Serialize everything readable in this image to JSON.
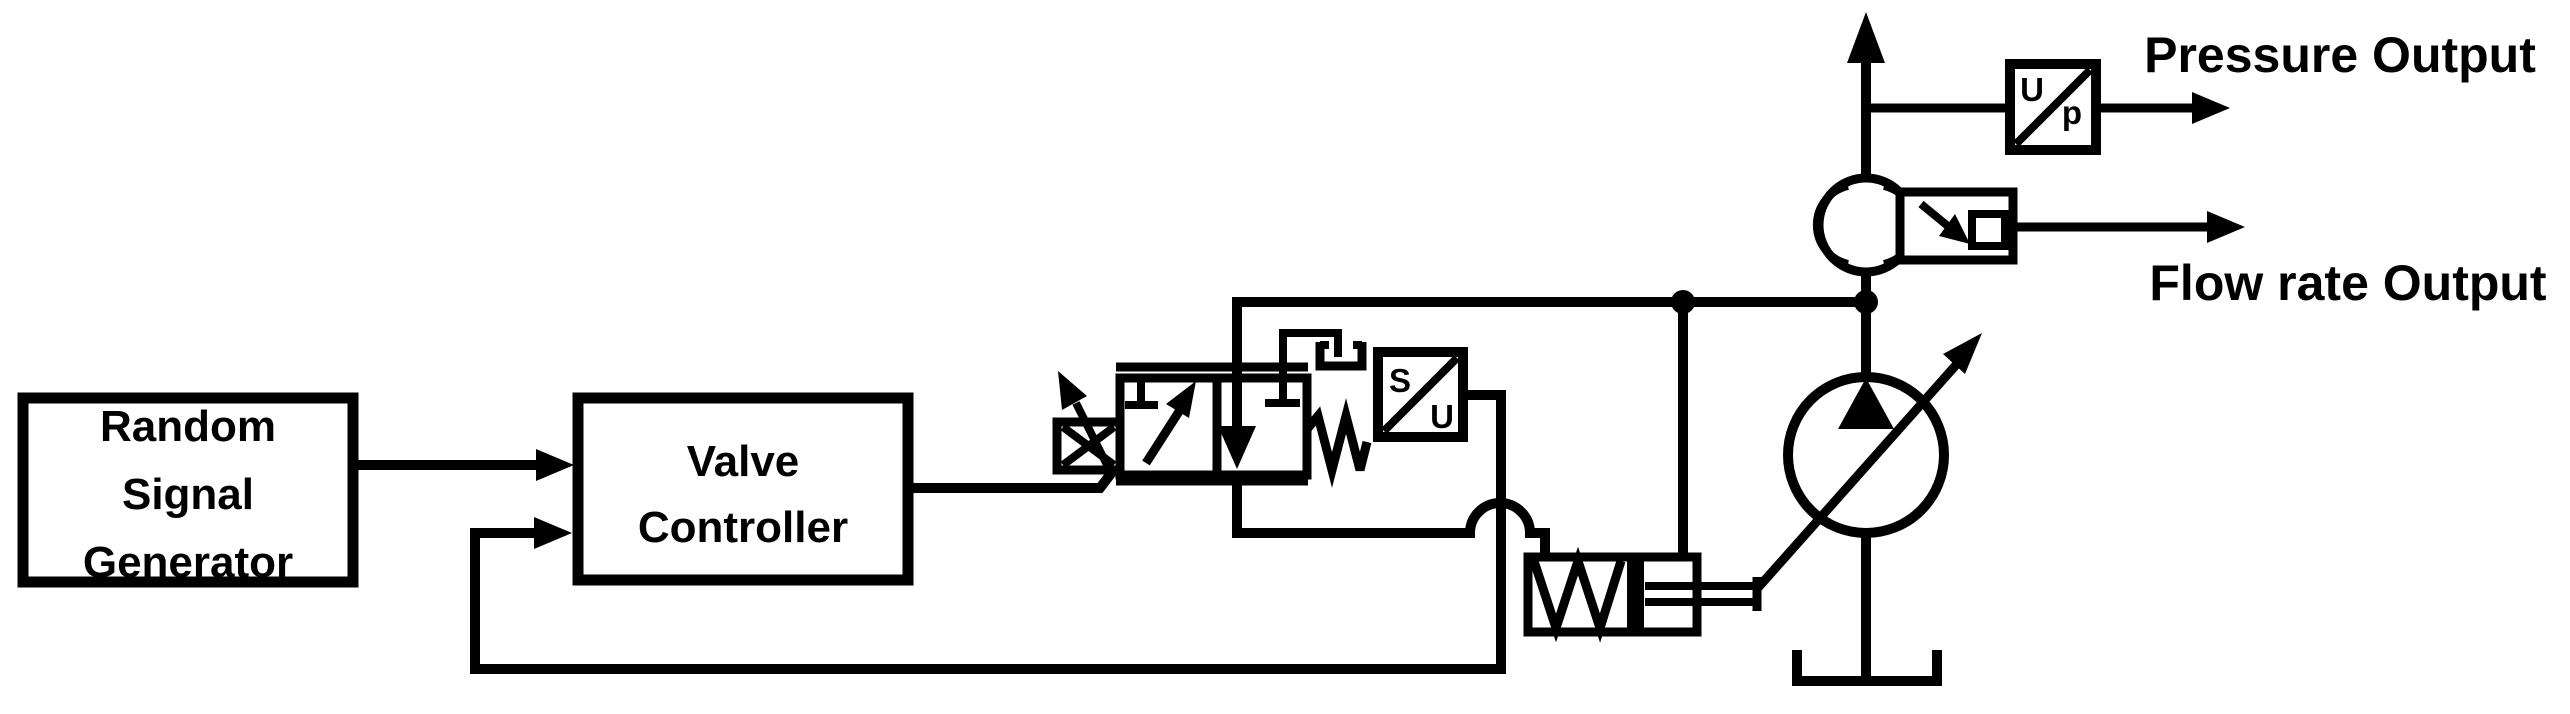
{
  "blocks": {
    "random_signal_generator": {
      "line1": "Random",
      "line2": "Signal",
      "line3": "Generator"
    },
    "valve_controller": {
      "line1": "Valve",
      "line2": "Controller"
    },
    "spool_position_sensor": {
      "top_label": "S",
      "bottom_label": "U"
    },
    "pressure_transducer": {
      "top_label": "U",
      "bottom_label": "p"
    }
  },
  "outputs": {
    "pressure_label": "Pressure Output",
    "flow_rate_label": "Flow rate Output"
  },
  "icons": {
    "pump": "variable-displacement-pump",
    "valve": "proportional-directional-valve",
    "flow_meter": "flow-meter",
    "tank": "tank",
    "cylinder": "pilot-control-cylinder"
  },
  "colors": {
    "stroke": "#000000",
    "background": "#ffffff"
  }
}
